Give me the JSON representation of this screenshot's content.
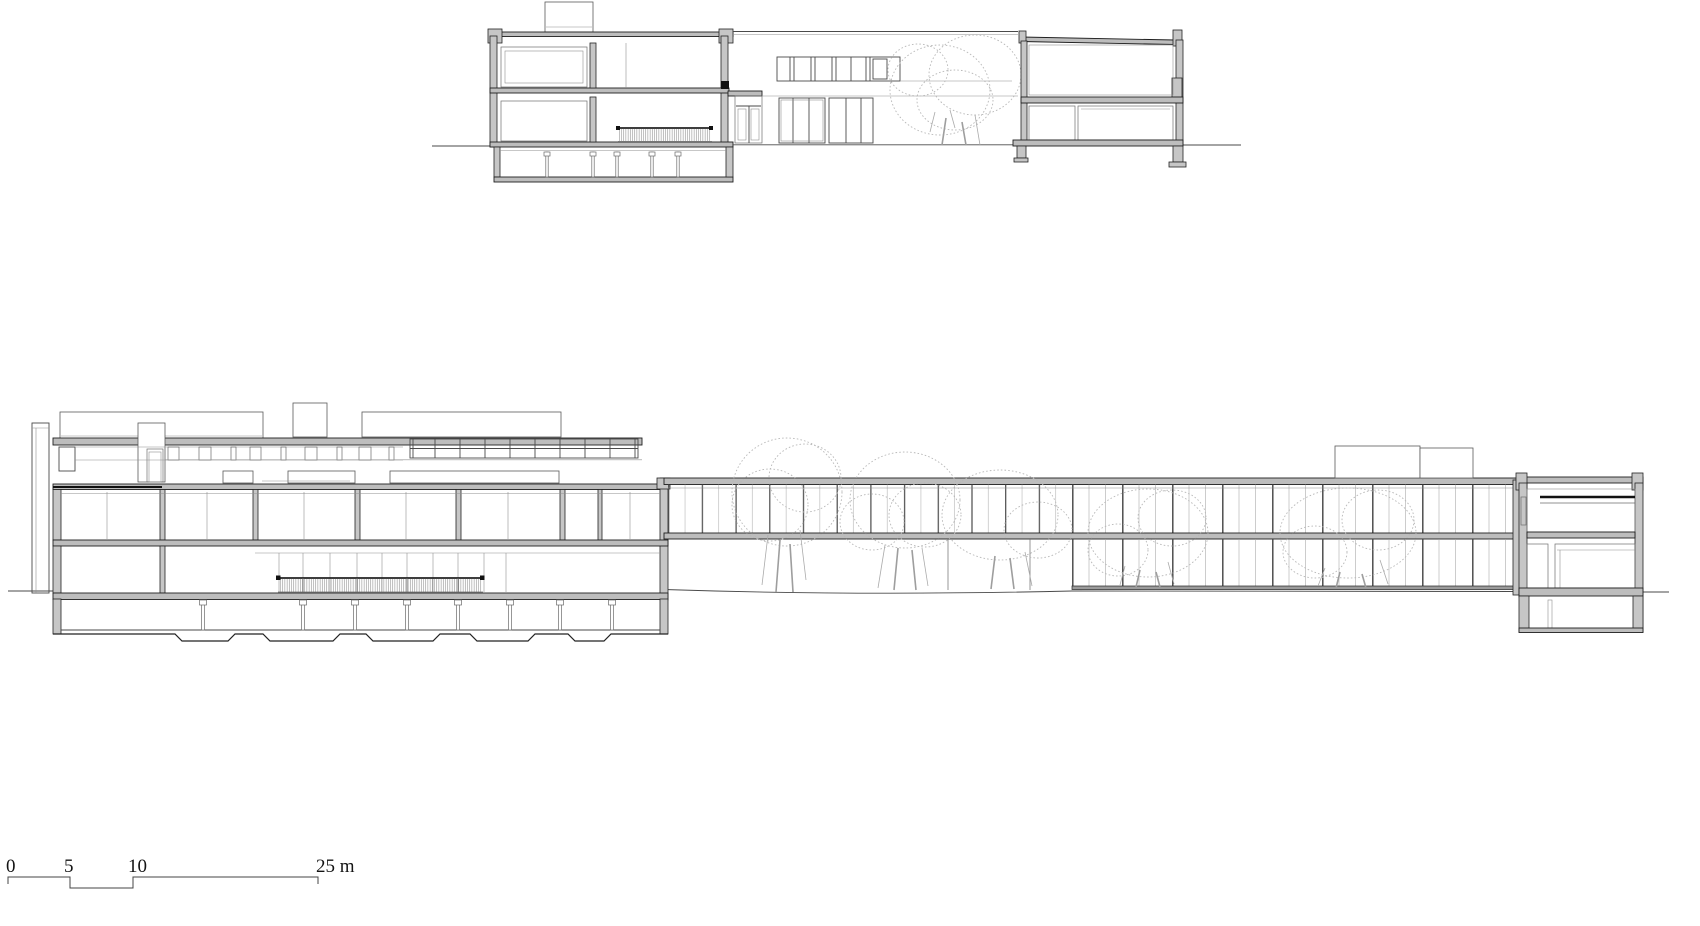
{
  "canvas": {
    "width": 1700,
    "height": 926,
    "background": "#ffffff"
  },
  "scale_bar": {
    "tick_labels": [
      "0",
      "5",
      "10",
      "25 m"
    ],
    "unit": "m"
  },
  "palette": {
    "cut_line": "#1f1f1f",
    "elevation_line": "#4a4a4a",
    "light_line": "#8f8f8f",
    "poche_fill": "#bdbdbd",
    "wall_fill": "#c6c6c6",
    "tree_line": "#b8b8b8",
    "text": "#141414"
  }
}
